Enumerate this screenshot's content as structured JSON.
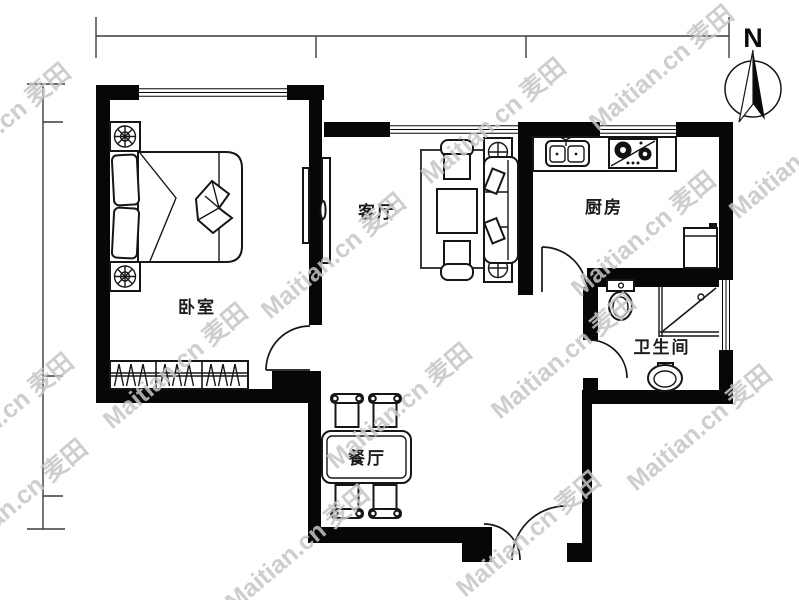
{
  "page": {
    "background": "#ffffff"
  },
  "compass": {
    "label": "N"
  },
  "rooms": {
    "bedroom": "卧室",
    "living": "客厅",
    "kitchen": "厨房",
    "bathroom": "卫生间",
    "dining": "餐厅"
  },
  "watermark": {
    "text": "Maitian.cn",
    "brand": "麦田",
    "color": "#c6c6c6",
    "instances": [
      [
        -65,
        190
      ],
      [
        -62,
        480
      ],
      [
        -48,
        566
      ],
      [
        112,
        430
      ],
      [
        270,
        320
      ],
      [
        430,
        185
      ],
      [
        598,
        132
      ],
      [
        234,
        612
      ],
      [
        336,
        470
      ],
      [
        500,
        420
      ],
      [
        580,
        298
      ],
      [
        738,
        220
      ],
      [
        636,
        492
      ],
      [
        465,
        598
      ]
    ]
  },
  "colors": {
    "wall": "#070707",
    "line": "#161616",
    "dimension": "#3c3c3c",
    "background": "#ffffff"
  }
}
